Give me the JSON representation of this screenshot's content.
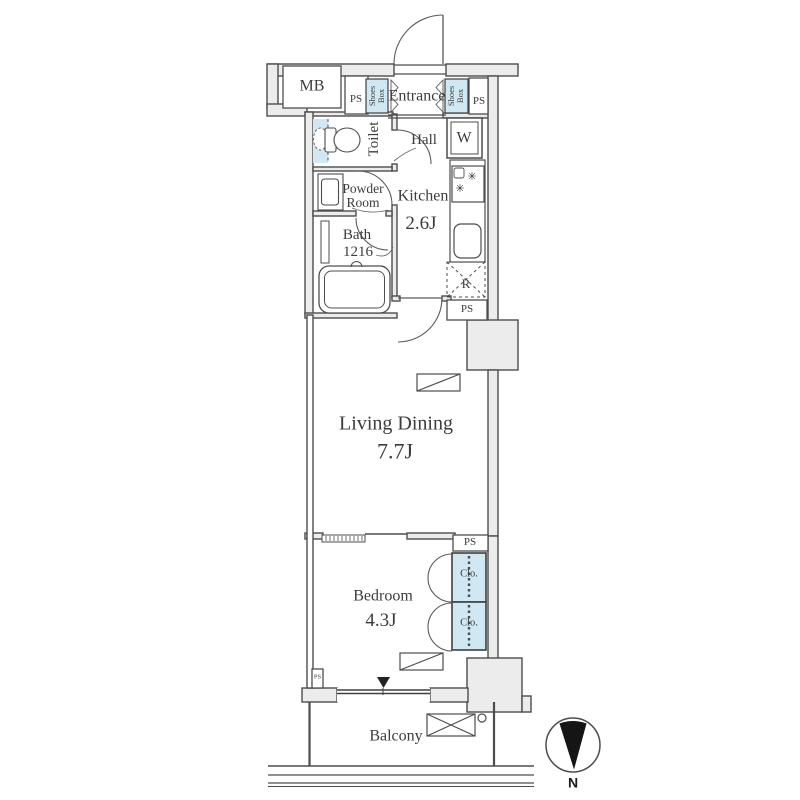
{
  "plan_type": "apartment-floorplan",
  "colors": {
    "wall_fill": "#ececec",
    "storage_fill": "#cfe8f3",
    "line": "#4d4d4d",
    "text": "#3c3c3c",
    "marker": "#1a1a1a"
  },
  "rooms": {
    "entrance": {
      "label": "Entrance"
    },
    "hall": {
      "label": "Hall"
    },
    "toilet": {
      "label": "Toilet"
    },
    "powder_room": {
      "label": "Powder Room"
    },
    "bath": {
      "label": "Bath",
      "size": "1216"
    },
    "kitchen": {
      "label": "Kitchen",
      "size": "2.6J"
    },
    "living_dining": {
      "label": "Living Dining",
      "size": "7.7J"
    },
    "bedroom": {
      "label": "Bedroom",
      "size": "4.3J"
    },
    "balcony": {
      "label": "Balcony"
    }
  },
  "fixtures": {
    "meter_box": "MB",
    "pipe_space": "PS",
    "shoes_box": "Shoes Box",
    "washer": "W",
    "refrigerator": "R",
    "closet": "Clo."
  },
  "icons": {
    "burner": "✳"
  },
  "compass": {
    "label": "N"
  }
}
